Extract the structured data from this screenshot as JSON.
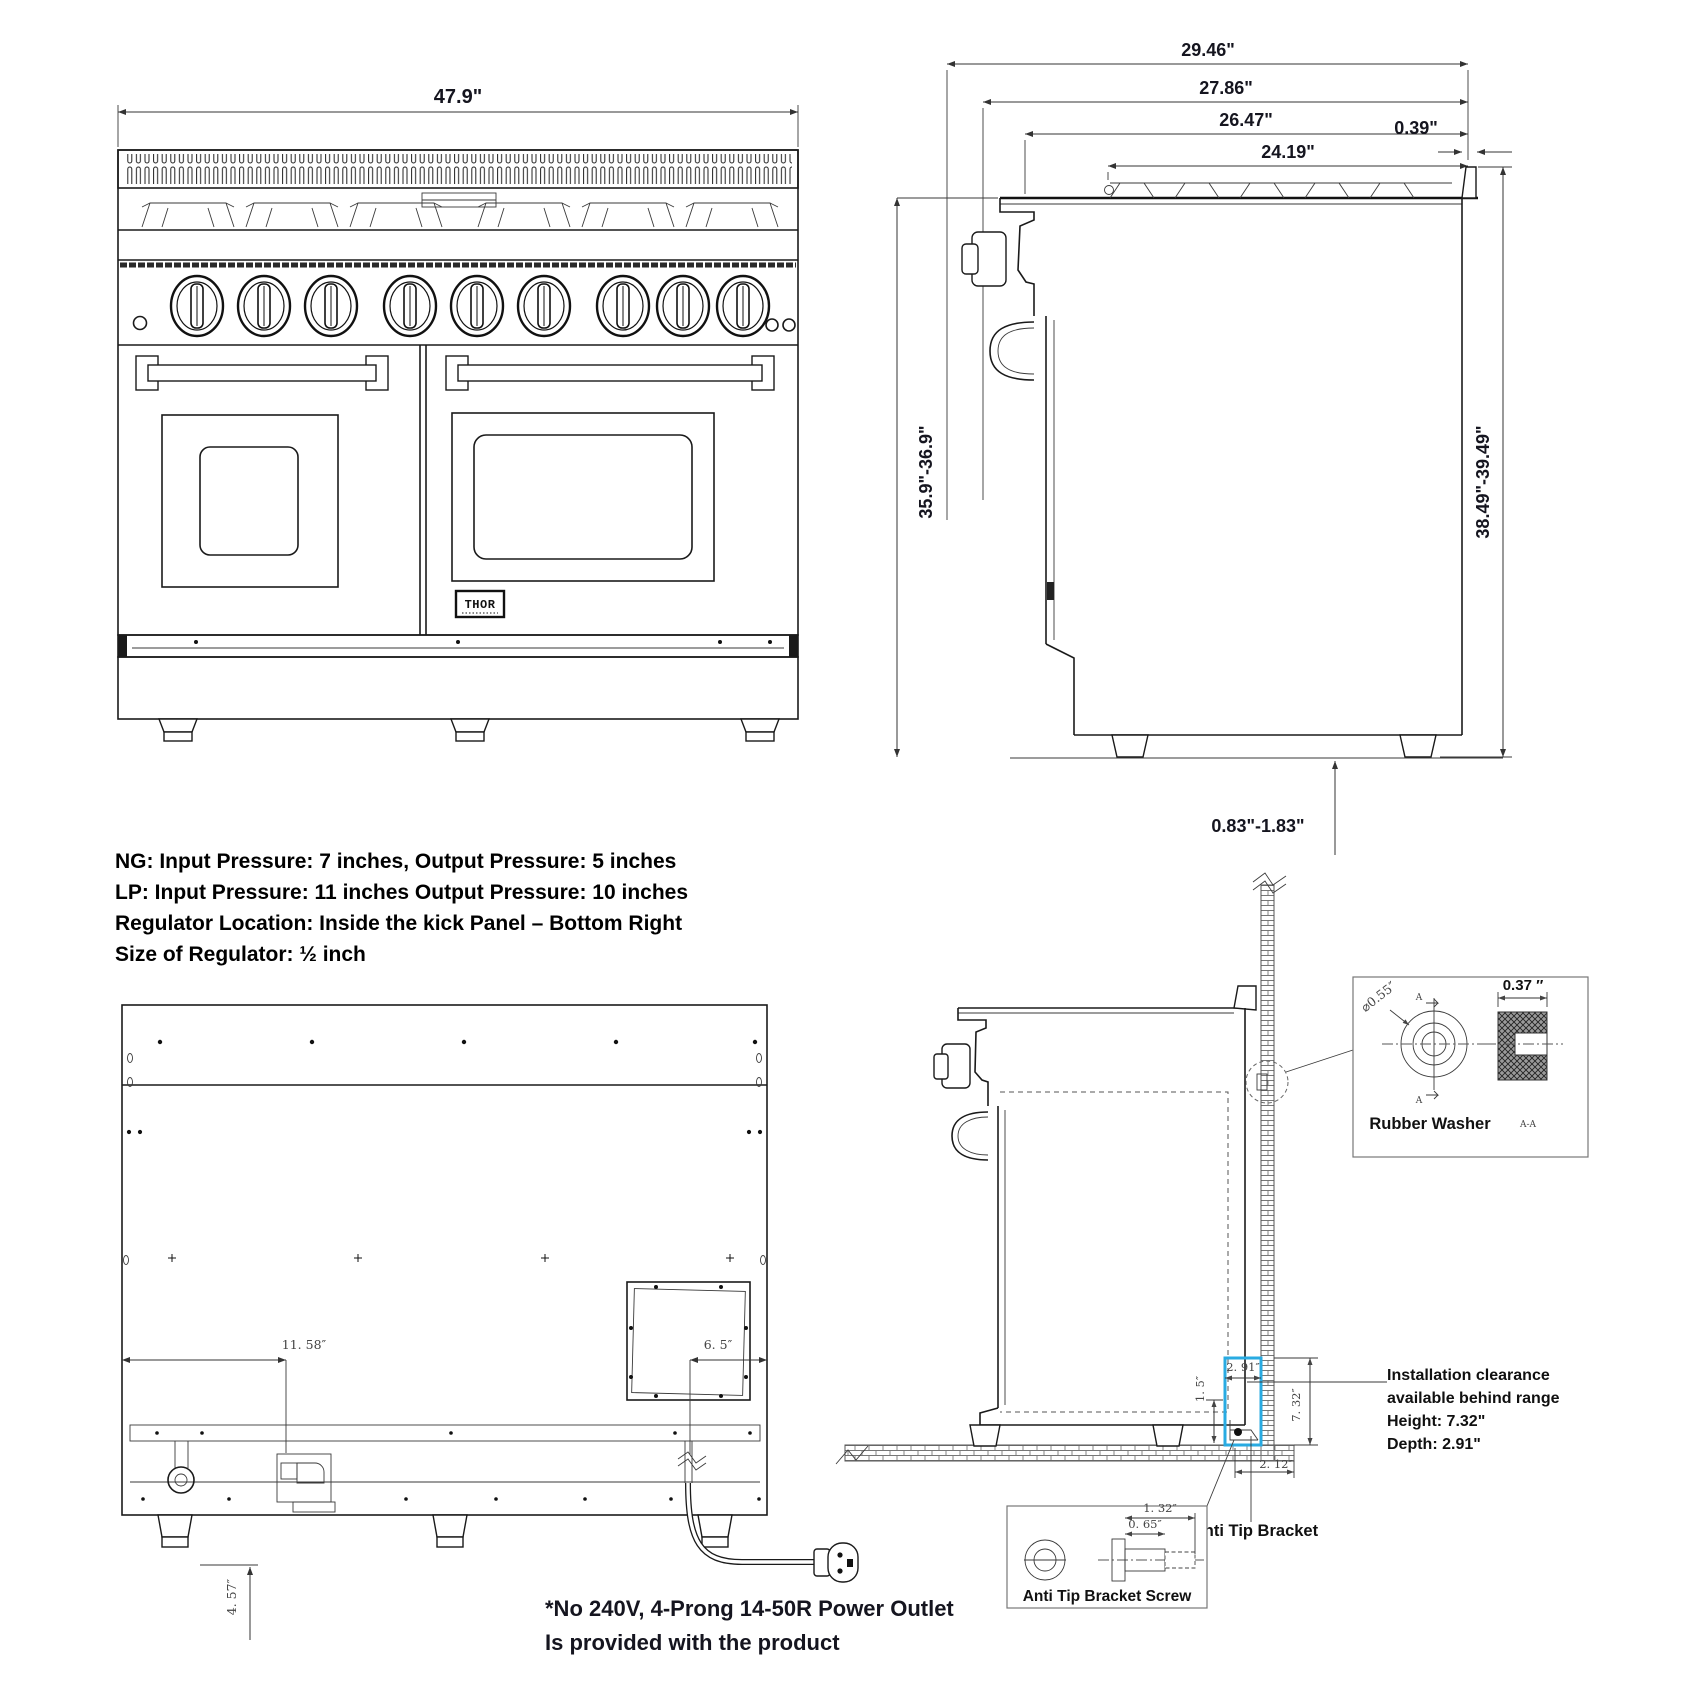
{
  "front_view": {
    "width": "47.9\"",
    "brand": "THOR"
  },
  "side_view": {
    "depth_total": "29.46\"",
    "depth_door": "27.86\"",
    "depth_body": "26.47\"",
    "depth_top": "24.19\"",
    "back_lip": "0.39\"",
    "height_front": "35.9\"-36.9\"",
    "height_back": "38.49\"-39.49\"",
    "leg_adjust": "0.83\"-1.83\""
  },
  "gas_note": {
    "line1": "NG: Input Pressure: 7 inches, Output Pressure: 5 inches",
    "line2": "LP: Input Pressure: 11 inches Output Pressure: 10 inches",
    "line3": "Regulator Location: Inside the kick Panel – Bottom Right",
    "line4": "Size of Regulator: ½ inch"
  },
  "back_view": {
    "gas_inlet_offset": "11. 58″",
    "junction_offset": "6. 5″",
    "gas_drop": "4. 57″"
  },
  "power_note": {
    "line1": "*No 240V, 4-Prong 14-50R Power Outlet",
    "line2": "Is provided with the product"
  },
  "install": {
    "clearance": {
      "line1": "Installation clearance",
      "line2": "available behind range",
      "line3": "Height: 7.32\"",
      "line4": "Depth: 2.91\""
    },
    "dims": {
      "depth": "2. 91″",
      "gap": "1. 5″",
      "height": "7. 32″",
      "bracket_offset": "2. 12″"
    },
    "anti_tip_bracket": "Anti Tip Bracket",
    "anti_tip_screw": "Anti Tip Bracket Screw",
    "screw": {
      "length": "1. 32″",
      "shaft": "0. 65″"
    },
    "washer": {
      "title": "Rubber Washer",
      "diameter": "⌀0.55″",
      "width": "0.37 ″",
      "section": "A-A",
      "marker": "A"
    }
  },
  "colors": {
    "highlight": "#29abe2",
    "line": "#1a1a1a"
  }
}
